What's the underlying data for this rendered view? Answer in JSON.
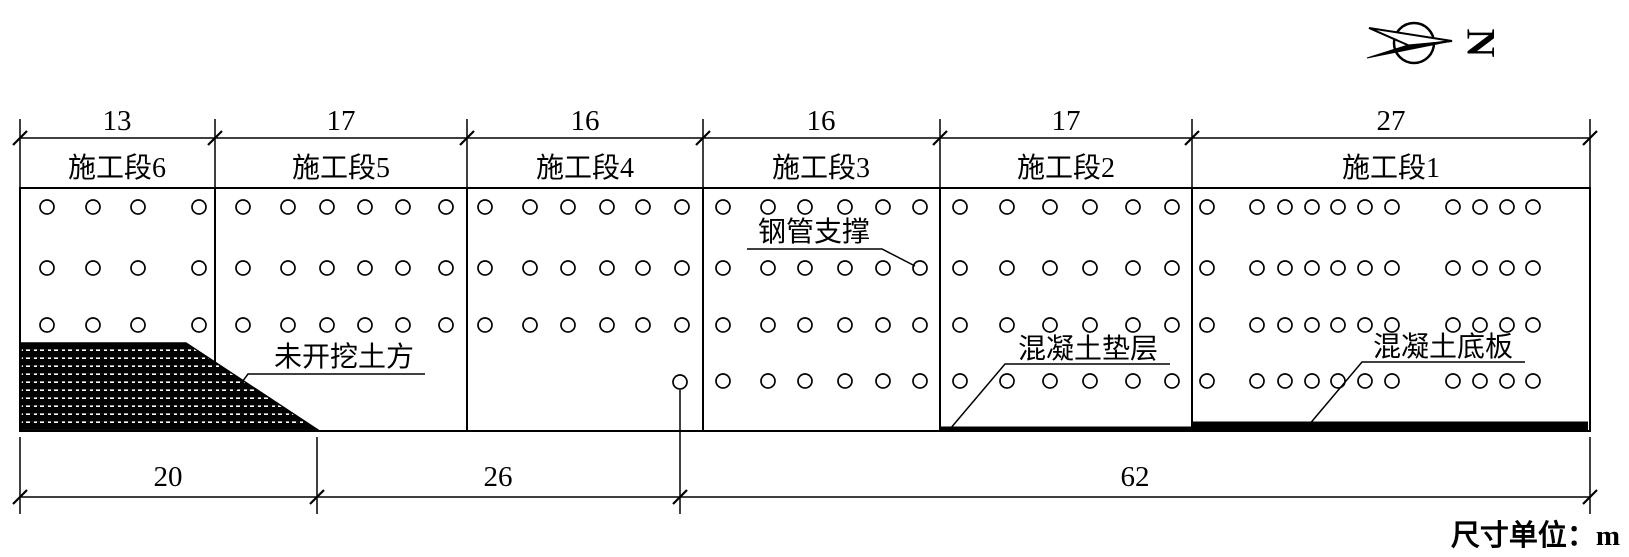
{
  "north_indicator": {
    "label": "N"
  },
  "top_dimension_row": {
    "values": [
      "13",
      "17",
      "16",
      "16",
      "17",
      "27"
    ]
  },
  "segment_row": {
    "labels": [
      "施工段6",
      "施工段5",
      "施工段4",
      "施工段3",
      "施工段2",
      "施工段1"
    ]
  },
  "bottom_dimension_row": {
    "values": [
      "20",
      "26",
      "62"
    ]
  },
  "callouts": {
    "unexcavated_soil": "未开挖土方",
    "steel_pipe_support": "钢管支撑",
    "concrete_cushion": "混凝土垫层",
    "concrete_base_slab": "混凝土底板"
  },
  "unit_note": "尺寸单位：m",
  "colors": {
    "ink": "#000000",
    "paper": "#ffffff"
  },
  "support_grid": [
    {
      "segment": "施工段6",
      "cols": [
        47,
        93,
        138,
        199
      ],
      "rows": [
        207,
        268,
        325
      ]
    },
    {
      "segment": "施工段5",
      "cols": [
        243,
        288,
        327,
        365,
        403,
        446
      ],
      "rows": [
        207,
        268,
        325
      ]
    },
    {
      "segment": "施工段4",
      "cols": [
        485,
        530,
        568,
        607,
        643,
        682
      ],
      "rows": [
        207,
        268,
        325
      ],
      "extra": [
        [
          680,
          382
        ]
      ]
    },
    {
      "segment": "施工段3",
      "cols": [
        723,
        768,
        805,
        845,
        883,
        920
      ],
      "rows": [
        207,
        268,
        325,
        381
      ]
    },
    {
      "segment": "施工段2",
      "cols": [
        960,
        1007,
        1050,
        1090,
        1133,
        1172
      ],
      "rows": [
        207,
        268,
        325,
        381
      ]
    },
    {
      "segment": "施工段1",
      "cols": [
        1207,
        1257,
        1285,
        1312,
        1338,
        1365,
        1392,
        1453,
        1480,
        1507,
        1533
      ],
      "rows": [
        207,
        268,
        325,
        381
      ]
    }
  ]
}
